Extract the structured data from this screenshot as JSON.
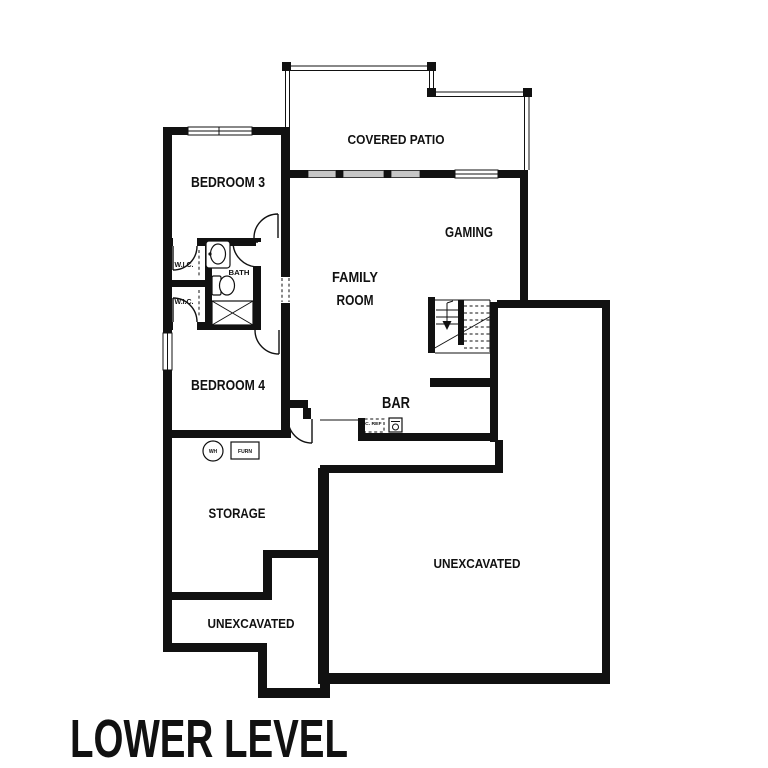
{
  "title": "LOWER LEVEL",
  "rooms": {
    "covered_patio": "COVERED PATIO",
    "bedroom3": "BEDROOM 3",
    "gaming": "GAMING",
    "family_line1": "FAMILY",
    "family_line2": "ROOM",
    "wic1": "W.I.C.",
    "wic2": "W.I.C.",
    "bath": "BATH",
    "bedroom4": "BEDROOM 4",
    "bar": "BAR",
    "storage": "STORAGE",
    "unexcavated_left": "UNEXCAVATED",
    "unexcavated_right": "UNEXCAVATED"
  },
  "fixtures": {
    "water_heater": "WH",
    "furnace": "FURN",
    "under_counter_fridge": "UC. REF"
  },
  "colors": {
    "ink": "#111111",
    "paper": "#ffffff",
    "slider_glass": "#c6c6c6"
  }
}
